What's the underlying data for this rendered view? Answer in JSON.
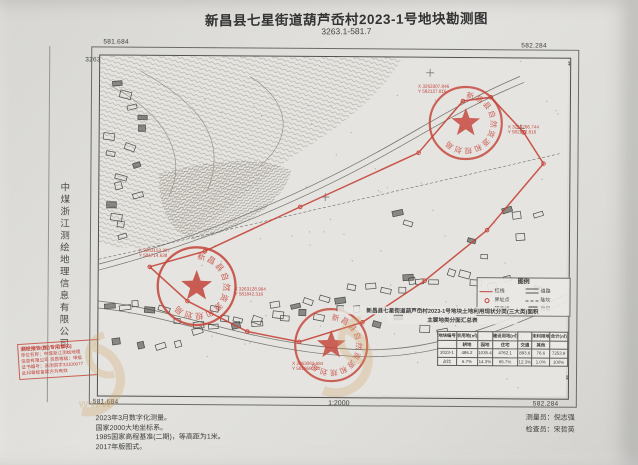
{
  "doc": {
    "title": "新昌县七星街道葫芦岙村2023-1号地块勘测图",
    "subtitle": "3263.1-581.7",
    "company_vertical": "中煤浙江测绘地理信息有限公司",
    "scale_label": "1:2000",
    "surveyor_label": "测量员：倪志强",
    "checker_label": "检查员：宋哲英",
    "notes": [
      "2023年3月数字化测量。",
      "国家2000大地坐标系。",
      "1985国家高程基准(二期)，等高距为1米。",
      "2017年版图式。"
    ]
  },
  "frame": {
    "top_left_e": "581.684",
    "top_left_n": "3263.454",
    "top_right_e": "582.284",
    "top_right_n": "3263.454",
    "bottom_right_n": "3263.054",
    "bottom_right_e": "582.284",
    "bottom_left_e": "581.684"
  },
  "red_stamp": {
    "lines": [
      "测绘报告(图)专用章(6)",
      "单位名称：中煤浙江测绘地理",
      "信息有限公司  资质等级：甲级",
      "证书编号：浙测资字33100077",
      "此印章经备案方为有效"
    ]
  },
  "seals": {
    "ring_text": "新昌县自然资源和规划局"
  },
  "annotations": [
    {
      "lines": [
        "X 3263307.846",
        "Y 582127.816"
      ]
    },
    {
      "lines": [
        "X 3263266.744",
        "Y 582172.816"
      ]
    },
    {
      "lines": [
        "X 3263153.207",
        "Y 581714.638"
      ]
    },
    {
      "lines": [
        "X 3263128.964",
        "Y 581842.316"
      ]
    },
    {
      "lines": [
        "X 3263062.584",
        "Y 581958.722"
      ]
    }
  ],
  "legend": {
    "title": "图例",
    "items": [
      {
        "sym": "redline",
        "label": "红线"
      },
      {
        "sym": "road",
        "label": "道路"
      },
      {
        "sym": "dot",
        "label": "界址点"
      },
      {
        "sym": "slope",
        "label": "陡坎"
      },
      {
        "sym": "contour",
        "label": "等高线"
      },
      {
        "sym": "house",
        "label": "房屋"
      }
    ]
  },
  "area_table": {
    "title_line1": "新昌县七星街道葫芦岙村2023-1号地块土地利用现状分类(三大类)面积",
    "title_line2": "主要地类分面汇总表",
    "grid": [
      [
        "地块编号",
        "农用地(㎡)",
        "",
        "建设用地(㎡)",
        "",
        "未利用地",
        "合计(㎡)"
      ],
      [
        "",
        "耕地",
        "园地",
        "住宅",
        "交通",
        "其他",
        ""
      ],
      [
        "2023-1",
        "486.2",
        "1035.4",
        "4762.1",
        "893.6",
        "76.6",
        "7253.9"
      ],
      [
        "占比",
        "6.7%",
        "14.3%",
        "65.7%",
        "12.3%",
        "1.0%",
        "100%"
      ]
    ]
  },
  "watermark": {
    "text": "www"
  }
}
